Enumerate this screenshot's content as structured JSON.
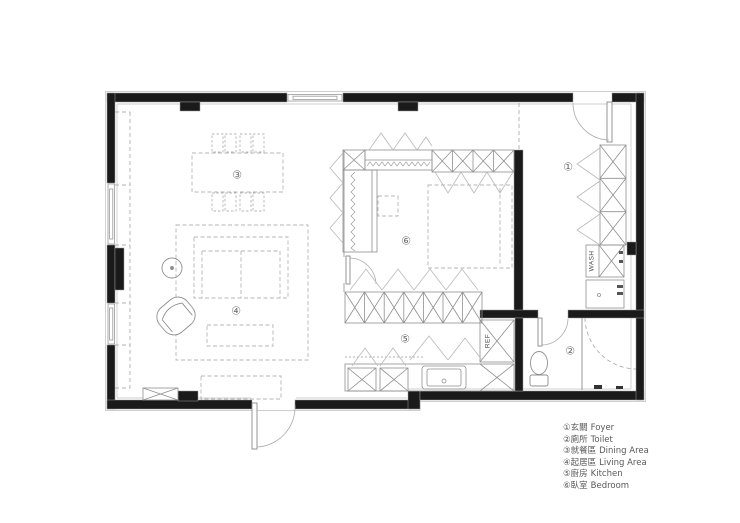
{
  "colors": {
    "wall": "#1a1a1a",
    "thin_line": "#8f8f8f",
    "furniture_dashed": "#b5b5b5",
    "chevron": "#b9b9b9",
    "legend_text": "#59595b"
  },
  "plan": {
    "appliances": {
      "washer": "WASH",
      "fridge": "REF"
    }
  },
  "legend": {
    "items": [
      {
        "num": "①",
        "zh": "玄關",
        "en": "Foyer"
      },
      {
        "num": "②",
        "zh": "廁所",
        "en": "Toilet"
      },
      {
        "num": "③",
        "zh": "就餐區",
        "en": "Dining Area"
      },
      {
        "num": "④",
        "zh": "起居區",
        "en": "Living Area"
      },
      {
        "num": "⑤",
        "zh": "廚房",
        "en": "Kitchen"
      },
      {
        "num": "⑥",
        "zh": "臥室",
        "en": "Bedroom"
      }
    ]
  }
}
